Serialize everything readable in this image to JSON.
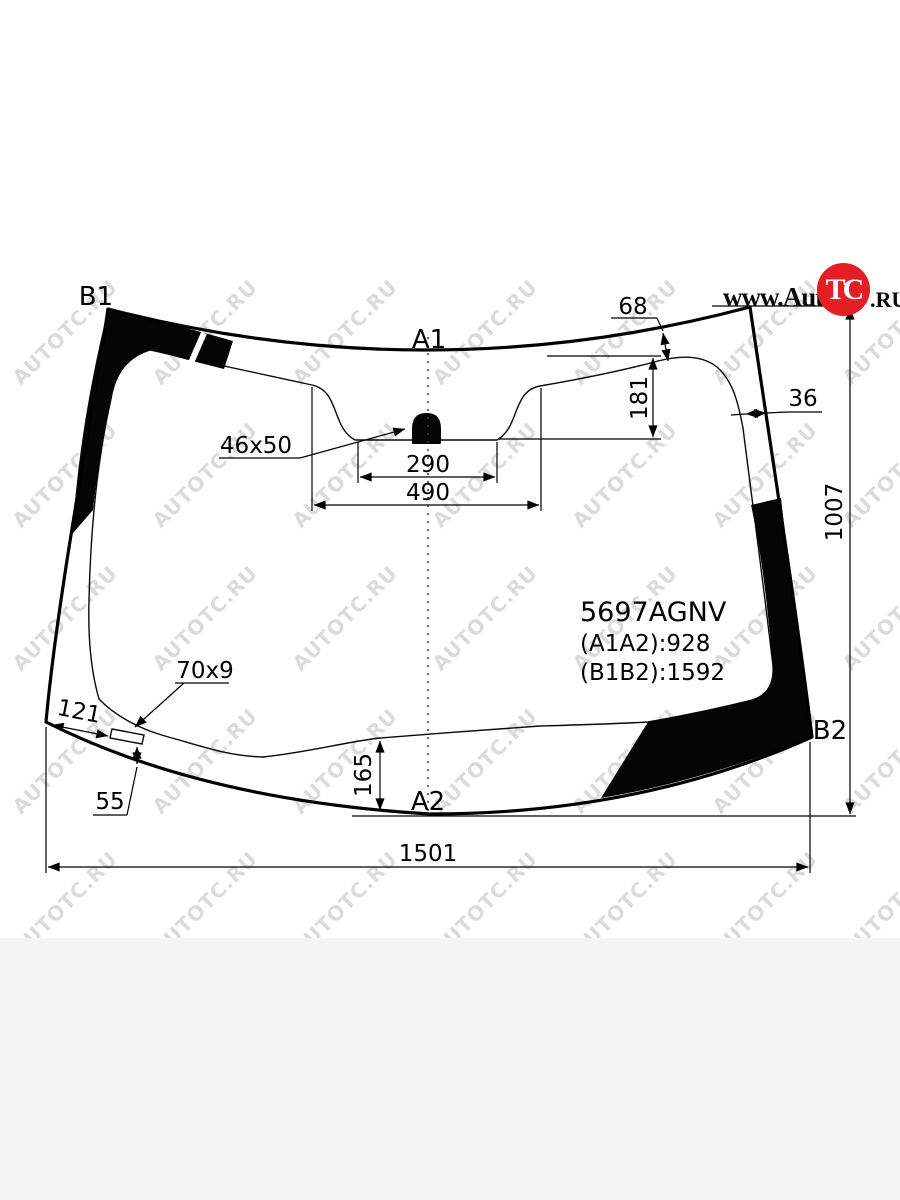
{
  "page": {
    "background_top": "#ffffff",
    "background_bottom": "#f4f4f4",
    "line_color": "#000000"
  },
  "logo": {
    "prefix": "www.Auto",
    "circle_text": "TC",
    "suffix": ".RU",
    "circle_color": "#e31e24"
  },
  "watermark": {
    "text": "AUTOTC.RU",
    "color": "rgba(125,125,125,0.28)",
    "cols": [
      65,
      205,
      345,
      485,
      625,
      765,
      895
    ],
    "rows": [
      332,
      475,
      618,
      761,
      904
    ]
  },
  "diagram": {
    "pillar_labels": {
      "b1": "B1",
      "a1": "A1",
      "b2": "B2",
      "a2": "A2"
    },
    "part_number": "5697AGNV",
    "distances": {
      "a1a2": "(A1A2):928",
      "b1b2": "(B1B2):1592"
    },
    "dimensions": {
      "top_band_offset": "68",
      "band_height": "181",
      "side_band_width": "36",
      "glass_height": "1007",
      "mirror_mount": "46x50",
      "mirror_inner_width": "290",
      "mirror_outer_width": "490",
      "edge_offset": "121",
      "sensor_size": "70x9",
      "sensor_to_edge": "55",
      "bottom_band_height": "165",
      "glass_width": "1501"
    }
  }
}
